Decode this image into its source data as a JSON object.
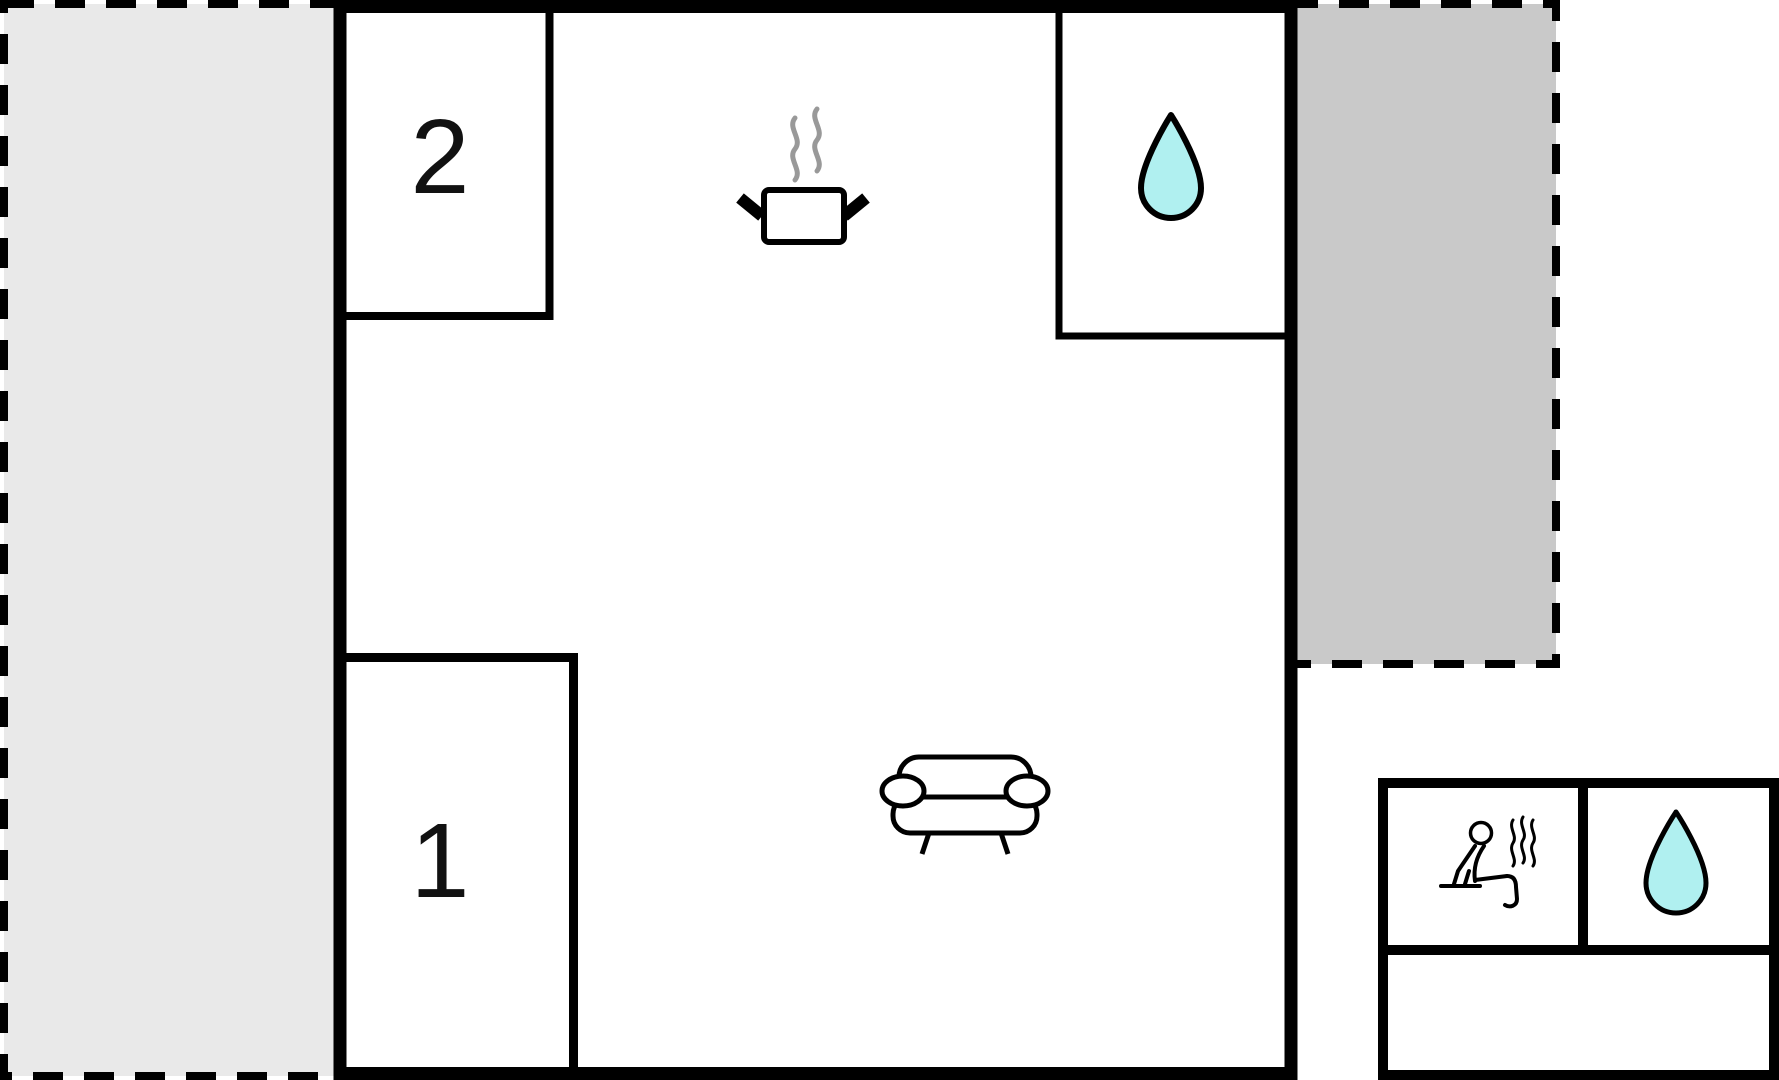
{
  "floorplan": {
    "title": "Holiday home floor plan",
    "rooms": {
      "bedroom2": {
        "label": "2"
      },
      "bedroom1": {
        "label": "1"
      },
      "kitchen": {
        "icon": "cooking-pot-with-steam"
      },
      "bathroom": {
        "icon": "water-drop"
      },
      "living_area": {
        "icon": "sofa"
      },
      "terrace_left": {
        "style": "dashed-outline"
      },
      "terrace_right": {
        "style": "dashed-outline"
      },
      "outbuilding": {
        "sauna": {
          "icon": "sauna-person-with-steam"
        },
        "shower": {
          "icon": "water-drop"
        }
      }
    },
    "colors": {
      "water": "#b0f0f0",
      "terrace_left": "#e9e9e9",
      "terrace_right": "#c9c9c9",
      "wall": "#000000",
      "steam": "#999999",
      "background": "#ffffff"
    }
  }
}
